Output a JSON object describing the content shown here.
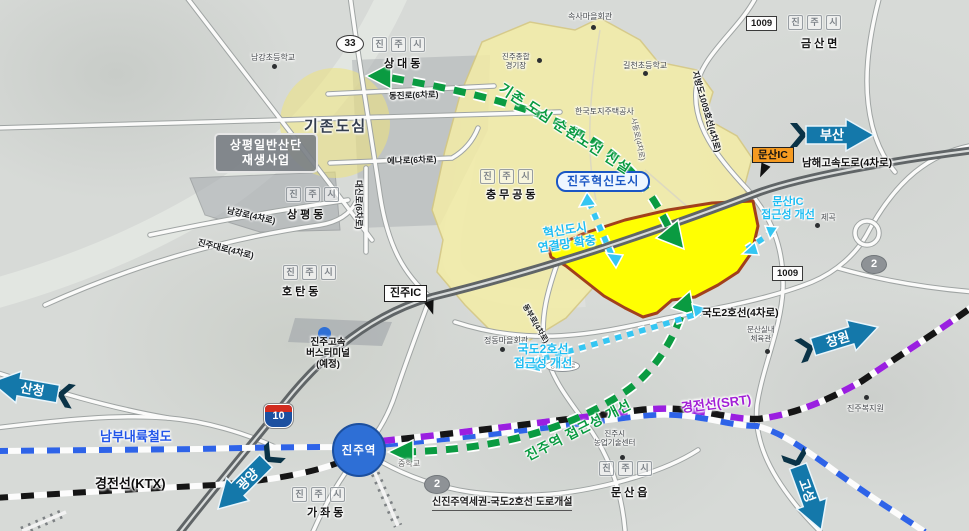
{
  "cities": {
    "jinju_si": "진주시"
  },
  "districts": {
    "sangdae": "상대동",
    "sangpyeong": "상평동",
    "chungmu": "충무공동",
    "hotan": "호탄동",
    "gajwa": "가좌동",
    "munsan": "문산읍",
    "geumsan": "금산면"
  },
  "places": {
    "namgang_school": "남강초등학교",
    "soksa_hall": "속사마을회관",
    "stadium_line1": "진주종합",
    "stadium_line2": "경기장",
    "gilcheon_school": "길천초등학교",
    "lh_corp": "한국토지주택공사",
    "jegok": "제곡",
    "munsan_gym_line1": "문산실내",
    "munsan_gym_line2": "체육관",
    "jeongdong_hall": "정동마을회관",
    "agri_line1": "진주시",
    "agri_line2": "농업기술센터",
    "welfare": "진주복지원",
    "middle_school": "중학교",
    "jeongchon_jct": "정촌교차로"
  },
  "roads": {
    "dongjin": "동진로(6차로)",
    "ena": "에나로(6차로)",
    "daesin": "대신로(6차로)",
    "namgang": "남강로(4차로)",
    "jinju_daero": "진주대로(4차로)",
    "jibang1009": "지방도1009호선(4차로)",
    "namhae_expwy": "남해고속도로(4차로)",
    "gukdo2": "국도2호선(4차로)",
    "dongbu": "동부로(4차로)",
    "sadong": "사동로(4차로)"
  },
  "routes": {
    "r33": "33",
    "r1009": "1009",
    "r2": "2",
    "r10": "10"
  },
  "boxes": {
    "regen_line1": "상평일반산단",
    "regen_line2": "재생사업",
    "munsan_ic": "문산IC",
    "jinju_ic": "진주IC",
    "innovation_city": "진주혁신도시",
    "existing_downtown": "기존도심"
  },
  "plans": {
    "loop_route": "기존 도심 순환노선 신설",
    "ic_access_line1": "문산IC",
    "ic_access_line2": "접근성 개선",
    "network_line1": "혁신도시",
    "network_line2": "연결망 확충",
    "gukdo2_access_line1": "국도2호선",
    "gukdo2_access_line2": "접근성 개선",
    "station_access": "진주역 접근성 개선",
    "new_road": "신진주역세권-국도2호선 도로개설"
  },
  "railways": {
    "srt": "경전선(SRT)",
    "ktx": "경전선(KTX)",
    "nambu": "남부내륙철도"
  },
  "stations": {
    "jinju_station": "진주역",
    "bus_terminal_line1": "진주고속",
    "bus_terminal_line2": "버스터미널",
    "bus_terminal_line3": "(예정)"
  },
  "directions": {
    "busan": "부산",
    "changwon": "창원",
    "sancheong": "산청",
    "gwangyang": "광양",
    "goseong": "고성"
  },
  "colors": {
    "site_yellow": "#ffff00",
    "site_border": "#a2401c",
    "innovation_area": "#f4eda6",
    "plan_green": "#0a9b41",
    "access_cyan": "#35c6f2",
    "arrow_teal": "#1478aa",
    "srt_purple": "#9a1fe0",
    "rail_blue": "#2e63e8",
    "ktx_black": "#151515",
    "ic_orange": "#f59a20",
    "innovation_blue": "#1a56c4"
  }
}
